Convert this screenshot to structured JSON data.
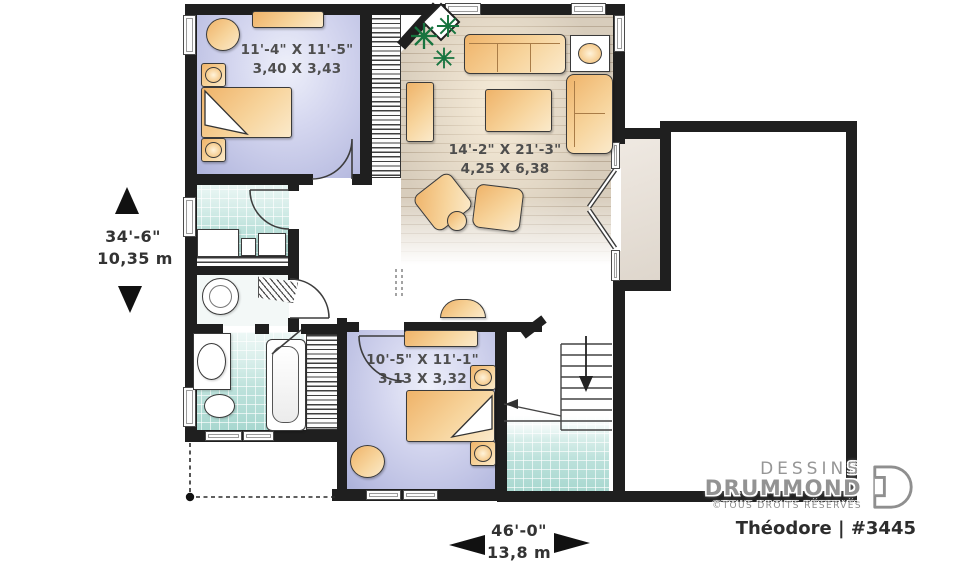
{
  "rooms": {
    "bedroom1": {
      "dim_ft": "11'-4\" X 11'-5\"",
      "dim_m": "3,40 X 3,43"
    },
    "living": {
      "dim_ft": "14'-2\" X 21'-3\"",
      "dim_m": "4,25 X 6,38"
    },
    "bedroom2": {
      "dim_ft": "10'-5\" X 11'-1\"",
      "dim_m": "3,13 X 3,32"
    }
  },
  "dimensions": {
    "depth_ft": "34'-6\"",
    "depth_m": "10,35 m",
    "width_ft": "46'-0\"",
    "width_m": "13,8 m"
  },
  "branding": {
    "name_line1": "DESSINS",
    "name_line2": "DRUMMOND",
    "rights": "©TOUS DROITS RÉSERVÉS",
    "plan_label": "Théodore | #3445"
  },
  "colors": {
    "wall": "#1f1f1f",
    "bedroom_floor": "#c3c6e8",
    "wood_floor": "#d8cdbc",
    "tile_floor": "#bfe2dc",
    "alcove_floor": "#e8e1d8",
    "furniture": "#f3c285",
    "plant_green": "#17743f",
    "label_text": "#4e4e4e",
    "logo_gray": "#949494"
  }
}
